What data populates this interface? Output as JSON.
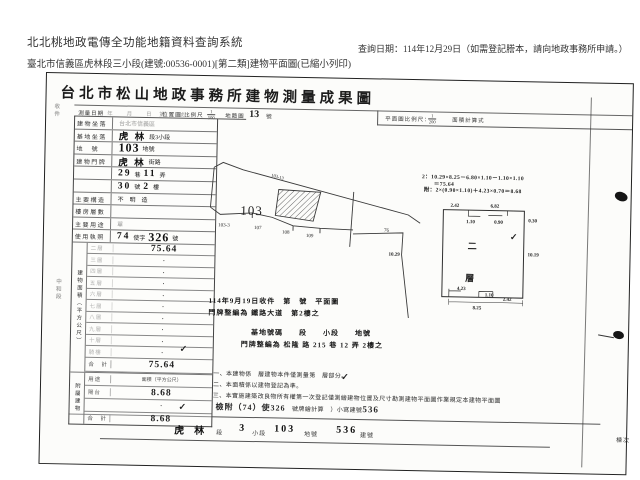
{
  "app": {
    "system_title": "北北桃地政電傳全功能地籍資料查詢系統",
    "document_line": "臺北市信義區虎林段三小段(建號:00536-0001)[第二類]建物平面圖(已縮小列印)",
    "query_date": "查詢日期：114年12月29日（如需登記謄本，請向地政事務所申請。）"
  },
  "doc": {
    "title": "台北市松山地政事務所建物測量成果圖",
    "band": {
      "c1": "測量日期",
      "c2": "年　　月　　日　第　　號",
      "c3": "位置圖",
      "c4": "比例尺",
      "f1n": "1",
      "f1d": "500",
      "c5": "地籍圖",
      "c6": "13",
      "c7": "號",
      "c8": "平面圖比例尺：",
      "f2n": "1",
      "f2d": "200",
      "c9": "面積計算式"
    },
    "side_marks": [
      {
        "t": "收件",
        "x": 6,
        "y": 30
      },
      {
        "t": "中和段",
        "x": 11,
        "y": 205
      }
    ],
    "info_rows": [
      {
        "label": "建物坐落",
        "dim": true,
        "segs": [
          {
            "t": "台北市信義區",
            "c": "p"
          }
        ]
      },
      {
        "label": "基地坐落",
        "dim": false,
        "segs": [
          {
            "t": "虎 林",
            "c": "h"
          },
          {
            "t": "段3小段",
            "c": "p"
          }
        ]
      },
      {
        "label": "地　號",
        "dim": false,
        "segs": [
          {
            "t": "103",
            "c": "h big"
          },
          {
            "t": "地號",
            "c": "p"
          }
        ]
      },
      {
        "label": "建物門牌",
        "dim": false,
        "segs": [
          {
            "t": "虎 林",
            "c": "h"
          },
          {
            "t": "街路",
            "c": "p"
          }
        ]
      },
      {
        "label": "",
        "dim": false,
        "segs": [
          {
            "t": "29",
            "c": "h"
          },
          {
            "t": "巷",
            "c": "p"
          },
          {
            "t": "11",
            "c": "h"
          },
          {
            "t": "弄",
            "c": "p"
          }
        ]
      },
      {
        "label": "",
        "dim": false,
        "segs": [
          {
            "t": "30",
            "c": "h"
          },
          {
            "t": "號",
            "c": "p"
          },
          {
            "t": "2",
            "c": "h"
          },
          {
            "t": "樓",
            "c": "p"
          }
        ]
      },
      {
        "label": "主要構造",
        "dim": false,
        "segs": [
          {
            "t": "不　明　造",
            "c": "p"
          }
        ]
      },
      {
        "label": "樓房層數",
        "dim": true,
        "segs": []
      },
      {
        "label": "主要用途",
        "dim": true,
        "segs": [
          {
            "t": "單",
            "c": "p"
          }
        ]
      },
      {
        "label": "使用執照",
        "dim": false,
        "segs": [
          {
            "t": "74",
            "c": "h"
          },
          {
            "t": "使字",
            "c": "p"
          },
          {
            "t": "326",
            "c": "h big"
          },
          {
            "t": "號",
            "c": "p"
          }
        ]
      }
    ],
    "area": {
      "col_label": "建物面積（平方公尺）",
      "rows": [
        {
          "f": "二層",
          "v": "75.64"
        },
        {
          "f": "三層",
          "v": "·"
        },
        {
          "f": "四層",
          "v": "·"
        },
        {
          "f": "五層",
          "v": "·"
        },
        {
          "f": "六層",
          "v": "·"
        },
        {
          "f": "七層",
          "v": "·"
        },
        {
          "f": "八層",
          "v": "·"
        },
        {
          "f": "九層",
          "v": "·"
        },
        {
          "f": "十層",
          "v": "·"
        },
        {
          "f": "騎樓",
          "v": "·"
        }
      ],
      "total_label": "合　計",
      "total": "75.64"
    },
    "annex": {
      "col_label": "附屬建物",
      "h1": "用途",
      "h2": "面積（平方公尺）",
      "rows": [
        {
          "u": "陽台",
          "v": "8.68"
        },
        {
          "u": "",
          "v": "·"
        }
      ],
      "total_label": "合　計",
      "total": "8.68"
    },
    "notes": {
      "n1": "一、本建物係　層建物本件僅測量第　層部分。",
      "n2": "二、本面積係以建物登記為準。",
      "n3": "三、本實施建築改良物所有權第一次登記僅測繪建物位置及尺寸勘測建物平面圖作業規定本建物平面圖",
      "n4a": "檢附（74）使326",
      "n4b": "　號牌繪計算　）小寫建號",
      "n4c": "536"
    },
    "bottom": [
      {
        "t": "虎",
        "c": "bh",
        "x": 106
      },
      {
        "t": "林",
        "c": "bh",
        "x": 126
      },
      {
        "t": "段",
        "c": "bp",
        "x": 148
      },
      {
        "t": "3",
        "c": "bh",
        "x": 171
      },
      {
        "t": "小段",
        "c": "bp",
        "x": 184
      },
      {
        "t": "103",
        "c": "bh",
        "x": 206
      },
      {
        "t": "地號",
        "c": "bp",
        "x": 236
      },
      {
        "t": "536",
        "c": "bh",
        "x": 268
      },
      {
        "t": "建號",
        "c": "bp",
        "x": 292
      },
      {
        "t": "棟次",
        "c": "bp",
        "x": 548
      }
    ],
    "annotations": [
      {
        "t": "114年9月19日收件　第　號　平面圖",
        "x": 166,
        "y": 219
      },
      {
        "t": "門牌整編為 鐵路大道　第2樓之",
        "x": 166,
        "y": 231
      },
      {
        "t": "基地號碼　　段　　小段　　地號",
        "x": 209,
        "y": 250
      },
      {
        "t": "門牌整編為 松隆 路 215 巷 12 弄 2樓之",
        "x": 199,
        "y": 262
      }
    ],
    "calcs": [
      {
        "t": "2：10.29×8.25－6.80×1.10－1.10×1.10",
        "x": 377,
        "y": 92
      },
      {
        "t": "＝75.64",
        "x": 389,
        "y": 99
      },
      {
        "t": "附：2×(0.90×1.10)＋4.23×0.70＝8.68",
        "x": 379,
        "y": 105
      }
    ],
    "checks": [
      {
        "x": 138,
        "y": 268
      },
      {
        "x": 138,
        "y": 326
      },
      {
        "x": 466,
        "y": 150
      },
      {
        "x": 300,
        "y": 293
      }
    ],
    "check_glyph": "✓",
    "sketch": {
      "parcel": "103",
      "tiny": "103-13",
      "s1": "103-3",
      "s2": "107",
      "s3": "108",
      "s4": "109",
      "s5": "76"
    },
    "plan": {
      "top1": "2.42",
      "top2": "6.82",
      "n1": "1.10",
      "n2": "0.90",
      "n3": "0.30",
      "left": "10.29",
      "right": "10.19",
      "b1": "4.23",
      "b2": "1.10",
      "b3": "2.42",
      "bottom": "8.25",
      "floor1": "二",
      "floor2": "層"
    }
  }
}
